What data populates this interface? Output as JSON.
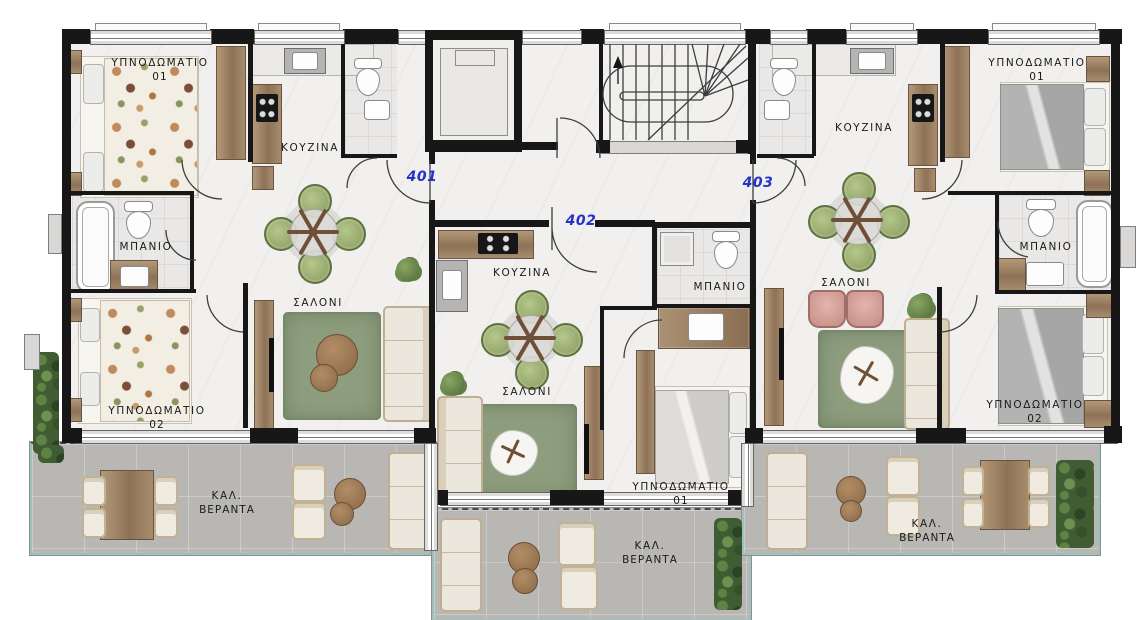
{
  "plan_type": "floor-plan",
  "colors": {
    "wall": "#171717",
    "interior_floor": "#f1f0ee",
    "veranda_tile": "#b8b7b4",
    "veranda_edge_teal": "#9cc2be",
    "rug_green": "#8d9d7e",
    "wood": "#9c8164",
    "chair_green": "#97a96c",
    "armchair_pink": "#d3a09a",
    "sofa_cream": "#ece7dc",
    "apartment_number_blue": "#2531c8",
    "label_text": "#1b1b1b"
  },
  "apartments": [
    {
      "number": "401",
      "rooms": [
        {
          "type": "bedroom-1",
          "label": "ΥΠΝΟΔΩΜΑΤΙΟ",
          "index": "01"
        },
        {
          "type": "kitchen",
          "label": "ΚΟΥΖΙΝΑ"
        },
        {
          "type": "bathroom",
          "label": "ΜΠΑΝΙΟ"
        },
        {
          "type": "bedroom-2",
          "label": "ΥΠΝΟΔΩΜΑΤΙΟ",
          "index": "02"
        },
        {
          "type": "living-room",
          "label": "ΣΑΛΟΝΙ"
        },
        {
          "type": "veranda",
          "label_line1": "ΚΑΛ.",
          "label_line2": "ΒΕΡΑΝΤΑ"
        }
      ]
    },
    {
      "number": "402",
      "rooms": [
        {
          "type": "kitchen",
          "label": "ΚΟΥΖΙΝΑ"
        },
        {
          "type": "living-room",
          "label": "ΣΑΛΟΝΙ"
        },
        {
          "type": "bathroom",
          "label": "ΜΠΑΝΙΟ"
        },
        {
          "type": "bedroom-1",
          "label": "ΥΠΝΟΔΩΜΑΤΙΟ",
          "index": "01"
        },
        {
          "type": "veranda",
          "label_line1": "ΚΑΛ.",
          "label_line2": "ΒΕΡΑΝΤΑ"
        }
      ]
    },
    {
      "number": "403",
      "rooms": [
        {
          "type": "bedroom-1",
          "label": "ΥΠΝΟΔΩΜΑΤΙΟ",
          "index": "01"
        },
        {
          "type": "kitchen",
          "label": "ΚΟΥΖΙΝΑ"
        },
        {
          "type": "bathroom",
          "label": "ΜΠΑΝΙΟ"
        },
        {
          "type": "bedroom-2",
          "label": "ΥΠΝΟΔΩΜΑΤΙΟ",
          "index": "02"
        },
        {
          "type": "living-room",
          "label": "ΣΑΛΟΝΙ"
        },
        {
          "type": "veranda",
          "label_line1": "ΚΑΛ.",
          "label_line2": "ΒΕΡΑΝΤΑ"
        }
      ]
    }
  ]
}
